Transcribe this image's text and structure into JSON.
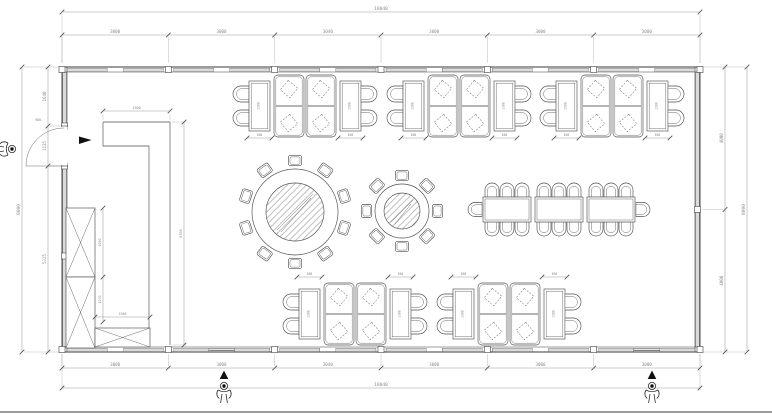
{
  "meta": {
    "drawing_type": "architectural-floor-plan",
    "subject": "restaurant-dining-room-furniture-layout"
  },
  "colors": {
    "background": "#ffffff",
    "wall_line": "#3a3a3a",
    "dimension_line": "#9a9a9a",
    "dimension_text": "#8a8a8a",
    "furniture_line": "#4f4f4f",
    "symbol_fill": "#101010"
  },
  "symbols": {
    "entry_figure": "person-top-view",
    "direction_arrow": "solid-triangle",
    "cabinet_cross": "x-box",
    "door": "quarter-circle-swing"
  },
  "dims": {
    "top_overall": "18040",
    "top_segments": [
      "3000",
      "3000",
      "3040",
      "3000",
      "3000",
      "3000"
    ],
    "bottom_segments": [
      "3000",
      "3000",
      "3040",
      "3000",
      "3000",
      "3000"
    ],
    "bottom_overall": "18040",
    "left_segments": [
      "1640",
      "1135",
      "5225"
    ],
    "left_overall": "8000",
    "right_segments": [
      "4000",
      "4000"
    ],
    "right_overall": "8000",
    "counter_width": "1900",
    "counter_length": "6300",
    "cabinet_h1": "1950",
    "cabinet_h2": "1270",
    "cabinet_w": "1560",
    "door_width": "900",
    "side_table_width": "650",
    "side_table_length": "1300"
  },
  "plan": {
    "wall": {
      "x1": 62,
      "y1": 67,
      "x2": 700,
      "y2": 352,
      "bays": 6
    },
    "door": {
      "y1": 126,
      "y2": 166
    },
    "counter_outer": "M103,122 H170 V345",
    "counter_inner": "M103,122 V146 H149 V328",
    "cabinets": [
      [
        66,
        208,
        29,
        69
      ],
      [
        66,
        277,
        29,
        71
      ],
      [
        95,
        328,
        55,
        19
      ]
    ],
    "booth_groups_top": [
      [
        234,
        75
      ],
      [
        388,
        75
      ],
      [
        541,
        75
      ]
    ],
    "booth_groups_bottom": [
      [
        284,
        283
      ],
      [
        438,
        283
      ]
    ],
    "round_tables": [
      {
        "cx": 295,
        "cy": 212,
        "ro": 43,
        "ri": 29,
        "chairs": 10
      },
      {
        "cx": 402,
        "cy": 211,
        "ro": 27,
        "ri": 18,
        "chairs": 8
      }
    ],
    "banquet": {
      "x": 483,
      "y": 197,
      "tw": 48,
      "th": 25,
      "gap": 4,
      "count": 3,
      "chairs_per_side": 3
    },
    "entries_x": [
      224,
      652
    ]
  }
}
